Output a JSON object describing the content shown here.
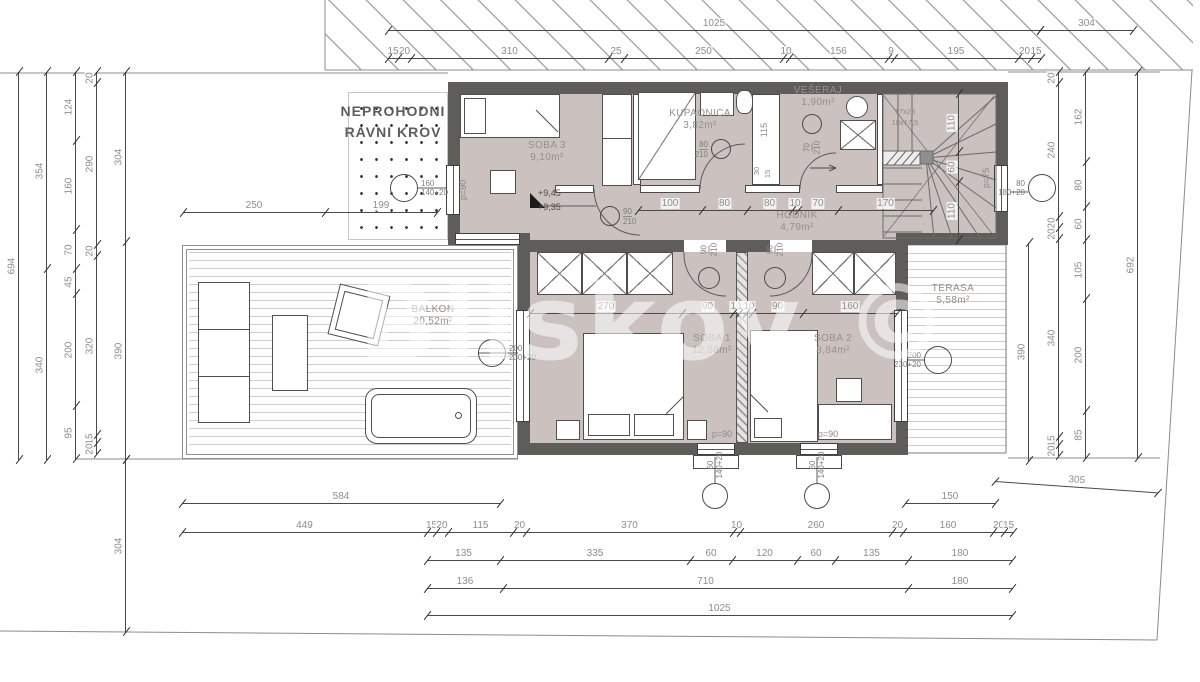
{
  "watermark": "Bliskov ©",
  "roof_note": {
    "line1": "NEPROHODNI",
    "line2": "RAVNI KROV"
  },
  "colors": {
    "floor": "#cbc1be",
    "wall": "#5f5d5a",
    "dim_line": "#4a4a4a",
    "dim_text": "#8d8d8d",
    "room_text": "#96908b",
    "hatch_line": "#a8a8a8",
    "watermark": "rgba(255,255,255,0.55)"
  },
  "rooms": [
    {
      "name": "SOBA 3",
      "area": "9,10m²",
      "cx": 547,
      "cy": 146
    },
    {
      "name": "KUPAONICA",
      "area": "3,82m²",
      "cx": 700,
      "cy": 114
    },
    {
      "name": "VEŠERAJ",
      "area": "1,90m²",
      "cx": 818,
      "cy": 91
    },
    {
      "name": "HODNIK",
      "area": "4,79m²",
      "cx": 797,
      "cy": 216
    },
    {
      "name": "SOBA 1",
      "area": "12,58m²",
      "cx": 712,
      "cy": 339
    },
    {
      "name": "SOBA 2",
      "area": "8,84m²",
      "cx": 833,
      "cy": 339
    },
    {
      "name": "BALKON",
      "area": "20,52m²",
      "cx": 433,
      "cy": 310
    },
    {
      "name": "TERASA",
      "area": "5,58m²",
      "cx": 953,
      "cy": 289
    }
  ],
  "dims": [
    {
      "id": "T1",
      "dir": "h",
      "x": 388,
      "y": 30,
      "segs": [
        [
          "1025",
          652
        ]
      ]
    },
    {
      "id": "T2",
      "dir": "h",
      "x": 1040,
      "y": 30,
      "segs": [
        [
          "304",
          93
        ]
      ]
    },
    {
      "id": "T3",
      "dir": "h",
      "x": 388,
      "y": 58,
      "segs": [
        [
          "15",
          10
        ],
        [
          "20",
          13
        ],
        [
          "310",
          197
        ],
        [
          "25",
          16
        ],
        [
          "250",
          159
        ],
        [
          "10",
          6
        ],
        [
          "156",
          99
        ],
        [
          "9",
          6
        ],
        [
          "195",
          124
        ],
        [
          "20",
          13
        ],
        [
          "15",
          10
        ]
      ]
    },
    {
      "id": "L1",
      "dir": "v",
      "x": 18,
      "y": 72,
      "segs": [
        [
          "694",
          388
        ]
      ]
    },
    {
      "id": "L2",
      "dir": "v",
      "x": 46,
      "y": 72,
      "segs": [
        [
          "354",
          197
        ],
        [
          "340",
          191
        ]
      ]
    },
    {
      "id": "L3",
      "dir": "v",
      "x": 75,
      "y": 72,
      "segs": [
        [
          "124",
          69
        ],
        [
          "160",
          89
        ],
        [
          "70",
          39
        ],
        [
          "45",
          25
        ],
        [
          "200",
          112
        ],
        [
          "95",
          53
        ]
      ]
    },
    {
      "id": "L4",
      "dir": "v",
      "x": 96,
      "y": 72,
      "segs": [
        [
          "20",
          11
        ],
        [
          "290",
          162
        ],
        [
          "20",
          11
        ],
        [
          "320",
          179
        ],
        [
          "15",
          8
        ],
        [
          "20",
          11
        ]
      ]
    },
    {
      "id": "L5",
      "dir": "v",
      "x": 125,
      "y": 72,
      "segs": [
        [
          "304",
          170
        ],
        [
          "390",
          218
        ]
      ]
    },
    {
      "id": "L6",
      "dir": "v",
      "x": 125,
      "y": 460,
      "segs": [
        [
          "304",
          172
        ]
      ]
    },
    {
      "id": "R1",
      "dir": "v",
      "x": 1058,
      "y": 72,
      "segs": [
        [
          "20",
          11
        ],
        [
          "240",
          134
        ],
        [
          "20",
          11
        ],
        [
          "20",
          11
        ],
        [
          "340",
          198
        ],
        [
          "15",
          8
        ],
        [
          "20",
          11
        ]
      ]
    },
    {
      "id": "R2",
      "dir": "v",
      "x": 1085,
      "y": 72,
      "segs": [
        [
          "162",
          90
        ],
        [
          "80",
          45
        ],
        [
          "60",
          33
        ],
        [
          "105",
          59
        ],
        [
          "200",
          112
        ],
        [
          "85",
          47
        ]
      ]
    },
    {
      "id": "R3",
      "dir": "v",
      "x": 1137,
      "y": 72,
      "segs": [
        [
          "692",
          386
        ]
      ]
    },
    {
      "id": "R4",
      "dir": "v",
      "x": 1028,
      "y": 243,
      "segs": [
        [
          "390",
          218
        ]
      ]
    },
    {
      "id": "S1",
      "dir": "v",
      "x": 958,
      "y": 94,
      "segs": [
        [
          "110",
          58
        ],
        [
          "60",
          30
        ],
        [
          "110",
          58
        ]
      ]
    },
    {
      "id": "C1",
      "dir": "h",
      "x": 183,
      "y": 212,
      "segs": [
        [
          "250",
          142
        ],
        [
          "199",
          112
        ]
      ]
    },
    {
      "id": "C2",
      "dir": "h",
      "x": 638,
      "y": 210,
      "segs": [
        [
          "100",
          64
        ],
        [
          "80",
          45
        ],
        [
          "80",
          45
        ],
        [
          "10",
          6
        ],
        [
          "70",
          40
        ],
        [
          "170",
          95
        ]
      ]
    },
    {
      "id": "C3",
      "dir": "h",
      "x": 530,
      "y": 313,
      "segs": [
        [
          "270",
          152
        ],
        [
          "90",
          51
        ],
        [
          "10",
          6
        ],
        [
          "10",
          7
        ],
        [
          "10",
          6
        ],
        [
          "90",
          51
        ],
        [
          "160",
          94
        ]
      ]
    },
    {
      "id": "B1",
      "dir": "h",
      "x": 182,
      "y": 503,
      "segs": [
        [
          "584",
          318
        ]
      ]
    },
    {
      "id": "B2",
      "dir": "h",
      "x": 905,
      "y": 503,
      "segs": [
        [
          "150",
          90
        ]
      ]
    },
    {
      "id": "B3",
      "dir": "h",
      "x": 182,
      "y": 532,
      "segs": [
        [
          "449",
          245
        ],
        [
          "15",
          9
        ],
        [
          "20",
          12
        ],
        [
          "115",
          65
        ],
        [
          "20",
          13
        ],
        [
          "370",
          207
        ],
        [
          "10",
          7
        ],
        [
          "260",
          152
        ],
        [
          "20",
          11
        ],
        [
          "160",
          90
        ],
        [
          "20",
          11
        ],
        [
          "15",
          9
        ]
      ]
    },
    {
      "id": "B4",
      "dir": "h",
      "x": 427,
      "y": 560,
      "segs": [
        [
          "135",
          73
        ],
        [
          "335",
          190
        ],
        [
          "60",
          42
        ],
        [
          "120",
          65
        ],
        [
          "60",
          38
        ],
        [
          "135",
          73
        ],
        [
          "180",
          104
        ]
      ]
    },
    {
      "id": "B5",
      "dir": "h",
      "x": 427,
      "y": 588,
      "segs": [
        [
          "136",
          76
        ],
        [
          "710",
          405
        ],
        [
          "180",
          104
        ]
      ]
    },
    {
      "id": "B6",
      "dir": "h",
      "x": 427,
      "y": 615,
      "segs": [
        [
          "1025",
          585
        ]
      ]
    },
    {
      "id": "B7",
      "dir": "h",
      "x": 995,
      "y": 481,
      "rot": 4,
      "segs": [
        [
          "305",
          163
        ]
      ]
    }
  ],
  "markers": [
    {
      "x": 404,
      "y": 188,
      "r": 14,
      "l": [
        "160",
        "140+20"
      ],
      "side": "right"
    },
    {
      "x": 492,
      "y": 353,
      "r": 14,
      "l": [
        "200",
        "230+20"
      ],
      "side": "right"
    },
    {
      "x": 938,
      "y": 360,
      "r": 14,
      "l": [
        "200",
        "230+20"
      ],
      "side": "left"
    },
    {
      "x": 1042,
      "y": 188,
      "r": 14,
      "l": [
        "80",
        "180+20"
      ],
      "side": "left"
    },
    {
      "x": 715,
      "y": 496,
      "r": 13,
      "l": [
        "60",
        "140+20"
      ],
      "side": "toprot"
    },
    {
      "x": 817,
      "y": 496,
      "r": 13,
      "l": [
        "60",
        "140+20"
      ],
      "side": "toprot"
    },
    {
      "x": 610,
      "y": 216,
      "r": 10,
      "l": [
        "90",
        "210"
      ],
      "side": "right",
      "frac": true
    },
    {
      "x": 721,
      "y": 149,
      "r": 10,
      "l": [
        "80",
        "210"
      ],
      "side": "left",
      "frac": true
    },
    {
      "x": 812,
      "y": 124,
      "r": 10,
      "l": [
        "70",
        "210"
      ],
      "side": "botrot",
      "frac": true
    },
    {
      "x": 709,
      "y": 278,
      "r": 11,
      "l": [
        "90",
        "210"
      ],
      "side": "toprot",
      "frac": true
    },
    {
      "x": 775,
      "y": 278,
      "r": 11,
      "l": [
        "90",
        "210"
      ],
      "side": "toprot",
      "frac": true
    }
  ],
  "annotations": [
    {
      "t": "+9,45",
      "x": 560,
      "y": 193,
      "rot": 0,
      "dark": true
    },
    {
      "t": "+9,35",
      "x": 560,
      "y": 207,
      "rot": 0,
      "dark": true
    },
    {
      "t": "p=90",
      "x": 463,
      "y": 190,
      "rot": 1
    },
    {
      "t": "p=75",
      "x": 986,
      "y": 178,
      "rot": 1
    },
    {
      "t": "p=90",
      "x": 722,
      "y": 434,
      "rot": 0
    },
    {
      "t": "p=90",
      "x": 828,
      "y": 434,
      "rot": 0
    },
    {
      "t": "115",
      "x": 764,
      "y": 130,
      "rot": 1
    },
    {
      "t": "30",
      "x": 757,
      "y": 171,
      "rot": 1,
      "small": true
    },
    {
      "t": "15",
      "x": 768,
      "y": 174,
      "rot": 1,
      "small": true
    },
    {
      "t": "17x28",
      "x": 905,
      "y": 112,
      "rot": 0,
      "small": true
    },
    {
      "t": "18x17,5",
      "x": 905,
      "y": 123,
      "rot": 0,
      "small": true
    }
  ]
}
